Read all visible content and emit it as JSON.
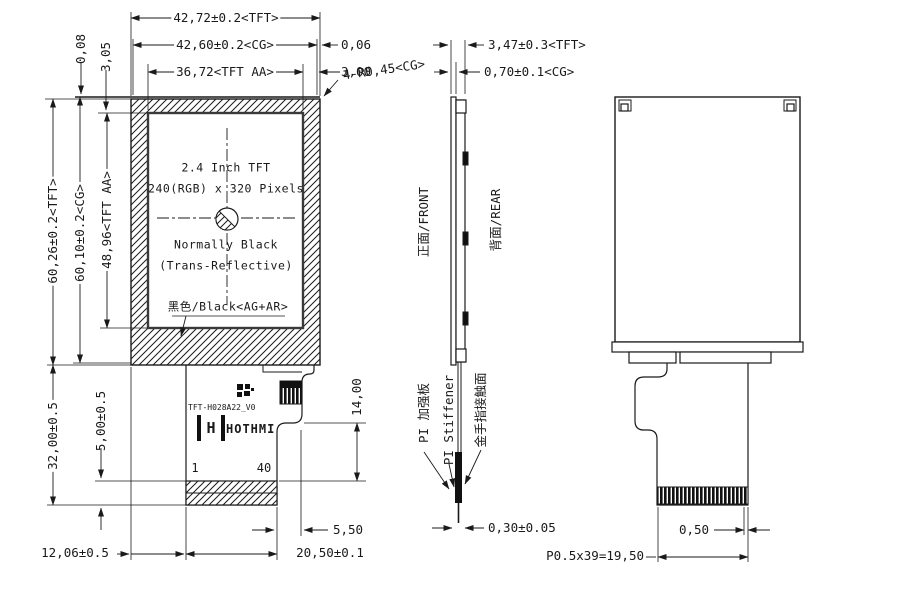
{
  "drawing": {
    "front_view": {
      "panel_text": {
        "size": "2.4 Inch TFT",
        "resolution": "240(RGB) x 320 Pixels",
        "mode": "Normally Black",
        "type": "(Trans-Reflective)",
        "surface": "黑色/Black<AG+AR>"
      },
      "fpc": {
        "model": "TFT-H028A22_V0",
        "brand": "HOTHMI",
        "logo_monogram": "H",
        "pin_first": "1",
        "pin_last": "40"
      },
      "dimensions": {
        "width_tft": "42,72±0.2<TFT>",
        "width_cg": "42,60±0.2<CG>",
        "width_aa": "36,72<TFT AA>",
        "edge_gap": "0,06",
        "aa_margin": "3,00",
        "corner_radius": "4-R0,45<CG>",
        "top_offset": "0,08",
        "top_margin": "3,05",
        "height_tft": "60,26±0.2<TFT>",
        "height_cg": "60,10±0.2<CG>",
        "height_aa": "48,96<TFT AA>",
        "fpc_length": "32,00±0.5",
        "gold_height": "5,00±0.5",
        "bottom_offset": "12,06±0.5",
        "fpc_width": "20,50±0.1",
        "fpc_notch": "5,50",
        "fpc_step": "14,00"
      }
    },
    "side_view": {
      "labels": {
        "front_face": "正面/FRONT",
        "rear_face": "背面/REAR",
        "stiffener_cn": "PI 加强板",
        "stiffener_en": "PI Stiffener",
        "gold_contact": "金手指接触面"
      },
      "dimensions": {
        "thickness_tft": "3,47±0.3<TFT>",
        "thickness_cg": "0,70±0.1<CG>",
        "stiffener_thickness": "0,30±0.05"
      }
    },
    "rear_view": {
      "dimensions": {
        "finger_width": "0,50",
        "finger_pitch": "P0.5x39=19,50"
      }
    },
    "colors": {
      "line": "#1a1a1a",
      "background": "#ffffff"
    }
  }
}
